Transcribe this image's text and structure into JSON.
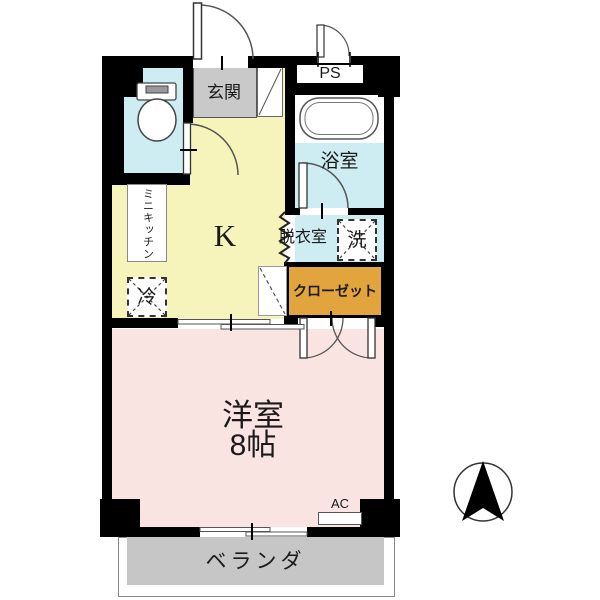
{
  "floorplan": {
    "rooms": {
      "entrance": "玄関",
      "pipe_space": "PS",
      "bathroom": "浴室",
      "kitchen": "K",
      "dressing_room": "脱衣室",
      "washer": "洗",
      "mini_kitchen": "ミニキッチン",
      "refrigerator": "冷",
      "closet": "クローゼット",
      "western_room": "洋室",
      "western_room_size": "8帖",
      "air_conditioner": "AC",
      "veranda": "ベランダ"
    },
    "colors": {
      "wall": "#000000",
      "kitchen_floor": "#f6f4bb",
      "wet_area_floor": "#cdedf2",
      "western_room_floor": "#f9e4e1",
      "entrance_floor": "#c9c9c9",
      "veranda_floor": "#c6c6c6",
      "closet_fill": "#e2a43c"
    }
  }
}
